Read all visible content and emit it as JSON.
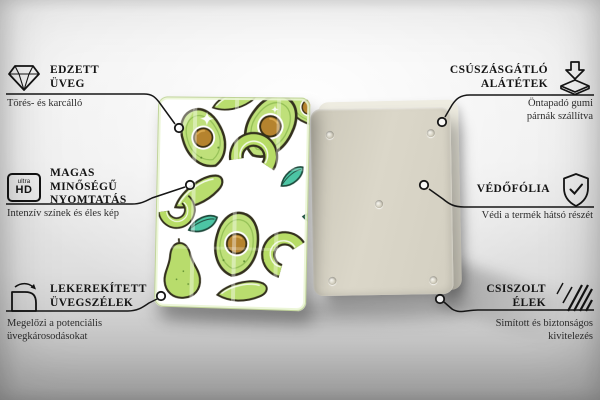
{
  "callouts": {
    "left": [
      {
        "icon": "diamond-icon",
        "title_lines": [
          "EDZETT",
          "ÜVEG"
        ],
        "subtitle_lines": [
          "Törés- és karcálló"
        ]
      },
      {
        "icon": "ultra-hd-icon",
        "icon_label_top": "ultra",
        "icon_label_bottom": "HD",
        "title_lines": [
          "MAGAS MINŐSÉGŰ",
          "NYOMTATÁS"
        ],
        "subtitle_lines": [
          "Intenzív színek és éles kép"
        ]
      },
      {
        "icon": "rounded-corner-icon",
        "title_lines": [
          "LEKEREKÍTETT",
          "ÜVEGSZÉLEK"
        ],
        "subtitle_lines": [
          "Megelőzi a potenciális",
          "üvegkárosodásokat"
        ]
      }
    ],
    "right": [
      {
        "icon": "anti-slip-pads-icon",
        "title_lines": [
          "CSÚSZÁSGÁTLÓ",
          "ALÁTÉTEK"
        ],
        "subtitle_lines": [
          "Öntapadó gumi",
          "párnák szállítva"
        ]
      },
      {
        "icon": "shield-check-icon",
        "title_lines": [
          "VÉDŐFÓLIA"
        ],
        "subtitle_lines": [
          "Védi a termék hátsó részét"
        ]
      },
      {
        "icon": "hatched-edges-icon",
        "title_lines": [
          "CSISZOLT",
          "ÉLEK"
        ],
        "subtitle_lines": [
          "Simított és biztonságos",
          "kivitelezés"
        ]
      }
    ]
  },
  "colors": {
    "callout_line": "#161616",
    "title_text": "#141414",
    "subtitle_text": "#2e2e2e",
    "board_back": "#d8d4c6",
    "board_back_film": "#e9e6da",
    "avocado_flesh": "#bfe07a",
    "avocado_outline": "#33301d",
    "avocado_pit": "#b5832e",
    "leaf_teal": "#4cc5a4",
    "background_top": "#f3f3f3",
    "background_bottom": "#b4b4b4"
  }
}
